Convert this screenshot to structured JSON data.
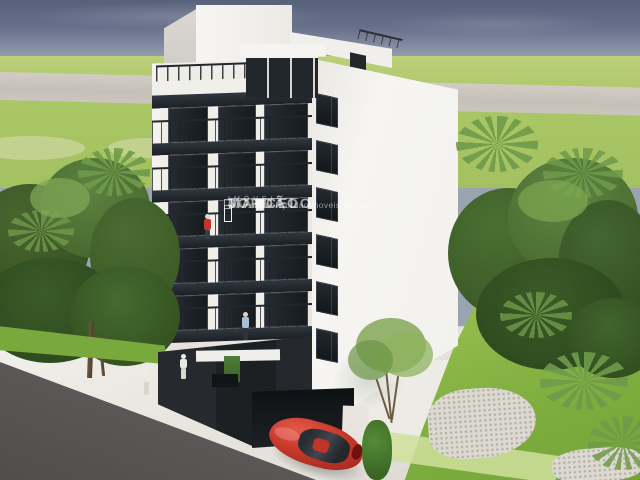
{
  "watermark": {
    "name_line1": "MARCELO",
    "name_line2": "JORDÃO",
    "tagline": "IMÓVEIS",
    "website": "www.marcelojordaoimoveis.com.br",
    "color": "#ffffff"
  },
  "scene": {
    "subject": "3D architectural rendering of a white six-storey residential building with dark glass balconies, tropical trees, lawn, street and a red sedan parked at the entrance",
    "figures": [
      "person-red-shirt-on-balcony",
      "person-blue-shirt-on-balcony",
      "pedestrian-white-1",
      "pedestrian-white-2"
    ],
    "vehicle": "red-sedan"
  },
  "palette": {
    "sky_top": "#57627a",
    "sky_horizon": "#aab0ba",
    "field_green": "#aac766",
    "lawn_green": "#7fae3f",
    "tree_dark": "#2f4d1f",
    "tree_light": "#7da750",
    "building_white": "#f4f3ef",
    "glass_dark": "#1f2429",
    "ground_charcoal": "#1f2326",
    "road_asphalt": "#5a5857",
    "plaza_white": "#e9e7e2",
    "distant_road": "#cac2bd",
    "car_red": "#c93a2c"
  }
}
